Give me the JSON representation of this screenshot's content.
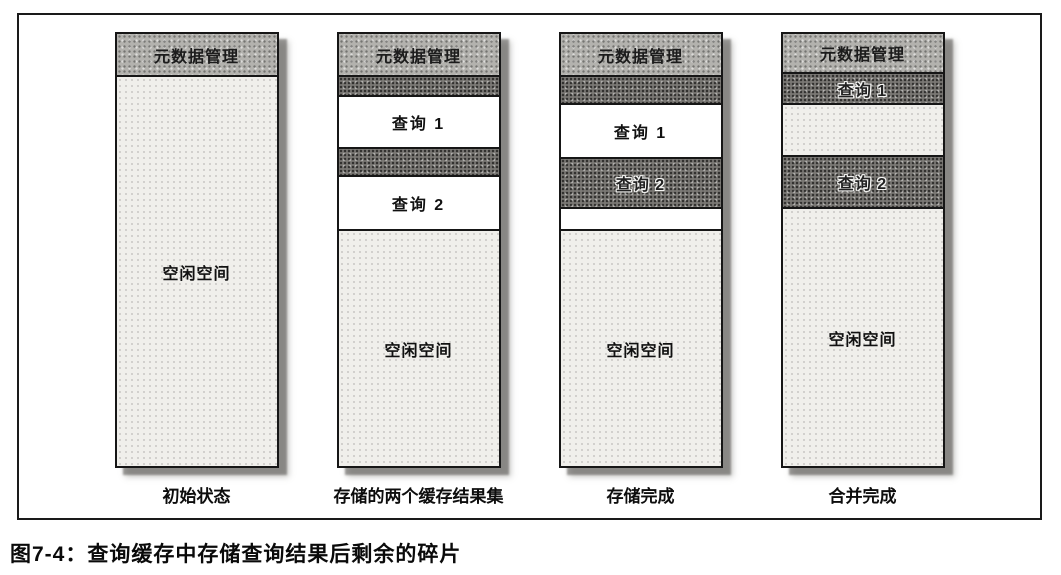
{
  "figure": {
    "caption": "图7-4：查询缓存中存储查询结果后剩余的碎片",
    "colors": {
      "header_band": "#b3b2ae",
      "query_band_dark": "#7a7874",
      "free_space": "#f0efeb",
      "frame_border": "#1a1a1a"
    },
    "columns": [
      {
        "stage_label": "初始状态",
        "segments": [
          {
            "kind": "header",
            "label": "元数据管理",
            "height": 41
          },
          {
            "kind": "free",
            "label": "空闲空间",
            "height": 391
          }
        ]
      },
      {
        "stage_label": "存储的两个缓存结果集",
        "segments": [
          {
            "kind": "header",
            "label": "元数据管理",
            "height": 41
          },
          {
            "kind": "dark",
            "label": "",
            "height": 20
          },
          {
            "kind": "white",
            "label": "查询 1",
            "height": 52
          },
          {
            "kind": "dark",
            "label": "",
            "height": 28
          },
          {
            "kind": "white",
            "label": "查询 2",
            "height": 54
          },
          {
            "kind": "free",
            "label": "空闲空间",
            "height": 237
          }
        ]
      },
      {
        "stage_label": "存储完成",
        "segments": [
          {
            "kind": "header",
            "label": "元数据管理",
            "height": 41
          },
          {
            "kind": "dark",
            "label": "",
            "height": 28
          },
          {
            "kind": "white",
            "label": "查询 1",
            "height": 54
          },
          {
            "kind": "dark",
            "label": "查询 2",
            "height": 50
          },
          {
            "kind": "white",
            "label": "",
            "height": 22
          },
          {
            "kind": "free",
            "label": "空闲空间",
            "height": 237
          }
        ]
      },
      {
        "stage_label": "合并完成",
        "segments": [
          {
            "kind": "header",
            "label": "元数据管理",
            "height": 38
          },
          {
            "kind": "dark",
            "label": "查询 1",
            "height": 31
          },
          {
            "kind": "free",
            "label": "",
            "height": 52
          },
          {
            "kind": "dark",
            "label": "查询 2",
            "height": 52
          },
          {
            "kind": "free",
            "label": "空闲空间",
            "height": 259
          }
        ]
      }
    ]
  }
}
